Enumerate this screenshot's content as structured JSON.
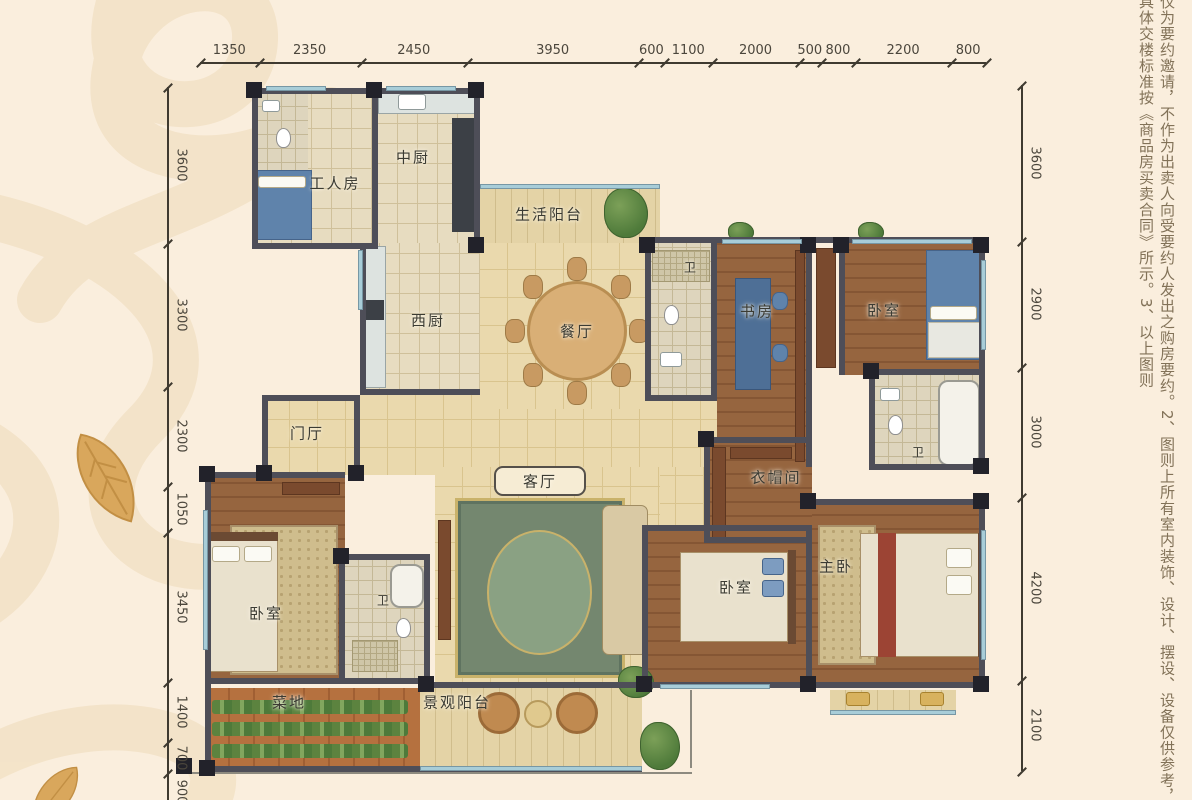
{
  "page": {
    "background": "#faeedd",
    "type": "apartment-floor-plan"
  },
  "dimensions": {
    "unit": "mm",
    "top": [
      "1350",
      "2350",
      "2450",
      "3950",
      "600",
      "1100",
      "2000",
      "500",
      "800",
      "2200",
      "800"
    ],
    "left": [
      "3600",
      "3300",
      "2300",
      "1050",
      "3450",
      "1400",
      "700",
      "900"
    ],
    "right": [
      "3600",
      "2900",
      "3000",
      "4200",
      "2100"
    ]
  },
  "rooms": [
    {
      "name": "corridor-main",
      "label": "",
      "floor": "hall",
      "x": 360,
      "y": 395,
      "w": 300,
      "h": 80
    },
    {
      "name": "corridor-bedrooms",
      "label": "",
      "floor": "hall",
      "x": 645,
      "y": 401,
      "w": 72,
      "h": 130
    },
    {
      "name": "corridor-south",
      "label": "",
      "floor": "hall",
      "x": 648,
      "y": 467,
      "w": 64,
      "h": 64
    },
    {
      "name": "worker-room",
      "label": "工人房",
      "floor": "tile",
      "x": 252,
      "y": 88,
      "w": 126,
      "h": 160,
      "lx": 335,
      "ly": 183
    },
    {
      "name": "worker-bath",
      "label": "",
      "floor": "bath",
      "x": 254,
      "y": 90,
      "w": 54,
      "h": 86
    },
    {
      "name": "chinese-kitchen",
      "label": "中厨",
      "floor": "tile",
      "x": 378,
      "y": 88,
      "w": 100,
      "h": 155,
      "lx": 413,
      "ly": 157
    },
    {
      "name": "service-balcony",
      "label": "生活阳台",
      "floor": "balcony",
      "x": 480,
      "y": 186,
      "w": 180,
      "h": 57,
      "lx": 549,
      "ly": 214
    },
    {
      "name": "western-kitchen",
      "label": "西厨",
      "floor": "tile",
      "x": 360,
      "y": 243,
      "w": 120,
      "h": 150,
      "lx": 428,
      "ly": 320
    },
    {
      "name": "dining-room",
      "label": "餐厅",
      "floor": "hall",
      "x": 480,
      "y": 243,
      "w": 165,
      "h": 166,
      "lx": 577,
      "ly": 331
    },
    {
      "name": "foyer",
      "label": "门厅",
      "floor": "hall",
      "x": 262,
      "y": 395,
      "w": 98,
      "h": 80,
      "lx": 307,
      "ly": 433
    },
    {
      "name": "living-room",
      "label": "客厅",
      "floor": "hall",
      "x": 435,
      "y": 467,
      "w": 225,
      "h": 215,
      "lx": 540,
      "ly": 481
    },
    {
      "name": "bath-middle",
      "label": "卫",
      "floor": "bath",
      "x": 645,
      "y": 243,
      "w": 72,
      "h": 158,
      "lx": 690,
      "ly": 267,
      "small": true
    },
    {
      "name": "study",
      "label": "书房",
      "floor": "wood",
      "x": 717,
      "y": 243,
      "w": 95,
      "h": 224,
      "lx": 757,
      "ly": 311
    },
    {
      "name": "bedroom-north",
      "label": "卧室",
      "floor": "wood",
      "x": 845,
      "y": 243,
      "w": 140,
      "h": 132,
      "lx": 884,
      "ly": 310
    },
    {
      "name": "bath-north",
      "label": "卫",
      "floor": "bath",
      "x": 875,
      "y": 375,
      "w": 110,
      "h": 95,
      "lx": 918,
      "ly": 452,
      "small": true
    },
    {
      "name": "cloakroom",
      "label": "衣帽间",
      "floor": "wood",
      "x": 710,
      "y": 443,
      "w": 102,
      "h": 100,
      "lx": 776,
      "ly": 477
    },
    {
      "name": "master-bedroom",
      "label": "主卧",
      "floor": "wood",
      "x": 812,
      "y": 505,
      "w": 173,
      "h": 177,
      "lx": 836,
      "ly": 566
    },
    {
      "name": "bedroom-south",
      "label": "卧室",
      "floor": "wood",
      "x": 648,
      "y": 531,
      "w": 164,
      "h": 151,
      "lx": 736,
      "ly": 587
    },
    {
      "name": "bedroom-west",
      "label": "卧室",
      "floor": "wood",
      "x": 205,
      "y": 478,
      "w": 140,
      "h": 200,
      "lx": 266,
      "ly": 613
    },
    {
      "name": "bath-west",
      "label": "卫",
      "floor": "bath",
      "x": 345,
      "y": 560,
      "w": 85,
      "h": 118,
      "lx": 383,
      "ly": 600,
      "small": true
    },
    {
      "name": "vegetable-garden",
      "label": "菜地",
      "floor": "soil",
      "x": 205,
      "y": 688,
      "w": 215,
      "h": 78,
      "lx": 289,
      "ly": 702
    },
    {
      "name": "view-balcony",
      "label": "景观阳台",
      "floor": "balcony",
      "x": 420,
      "y": 688,
      "w": 222,
      "h": 78,
      "lx": 457,
      "ly": 702
    },
    {
      "name": "bay-window-master",
      "label": "",
      "floor": "balcony",
      "x": 830,
      "y": 690,
      "w": 126,
      "h": 20
    }
  ],
  "disclaimer": "仅为要约邀请，不作为出卖人向受要约人发出之购房要约。2、图则上所有室内装饰、设计、摆设、设备仅供参考，具体交楼标准按《商品房买卖合同》所示。3、以上图则",
  "colors": {
    "background": "#faeedd",
    "wall": "#4e4e58",
    "column": "#22222a",
    "window": "#a8cdd8",
    "hall_floor": "#ead9ad",
    "wood_floor": "#96653f",
    "bath_floor": "#ded5bd",
    "soil": "#b5713f",
    "rug_green": "#74876f",
    "bed_blue": "#5f83ab",
    "dimension_text": "#4b463c",
    "label_text": "#3b3b33",
    "disclaimer_text": "#827258",
    "watermark": "#f3e2c7",
    "leaf": "#d9a75c"
  },
  "icons": [
    "script-watermark",
    "leaf-icon"
  ]
}
